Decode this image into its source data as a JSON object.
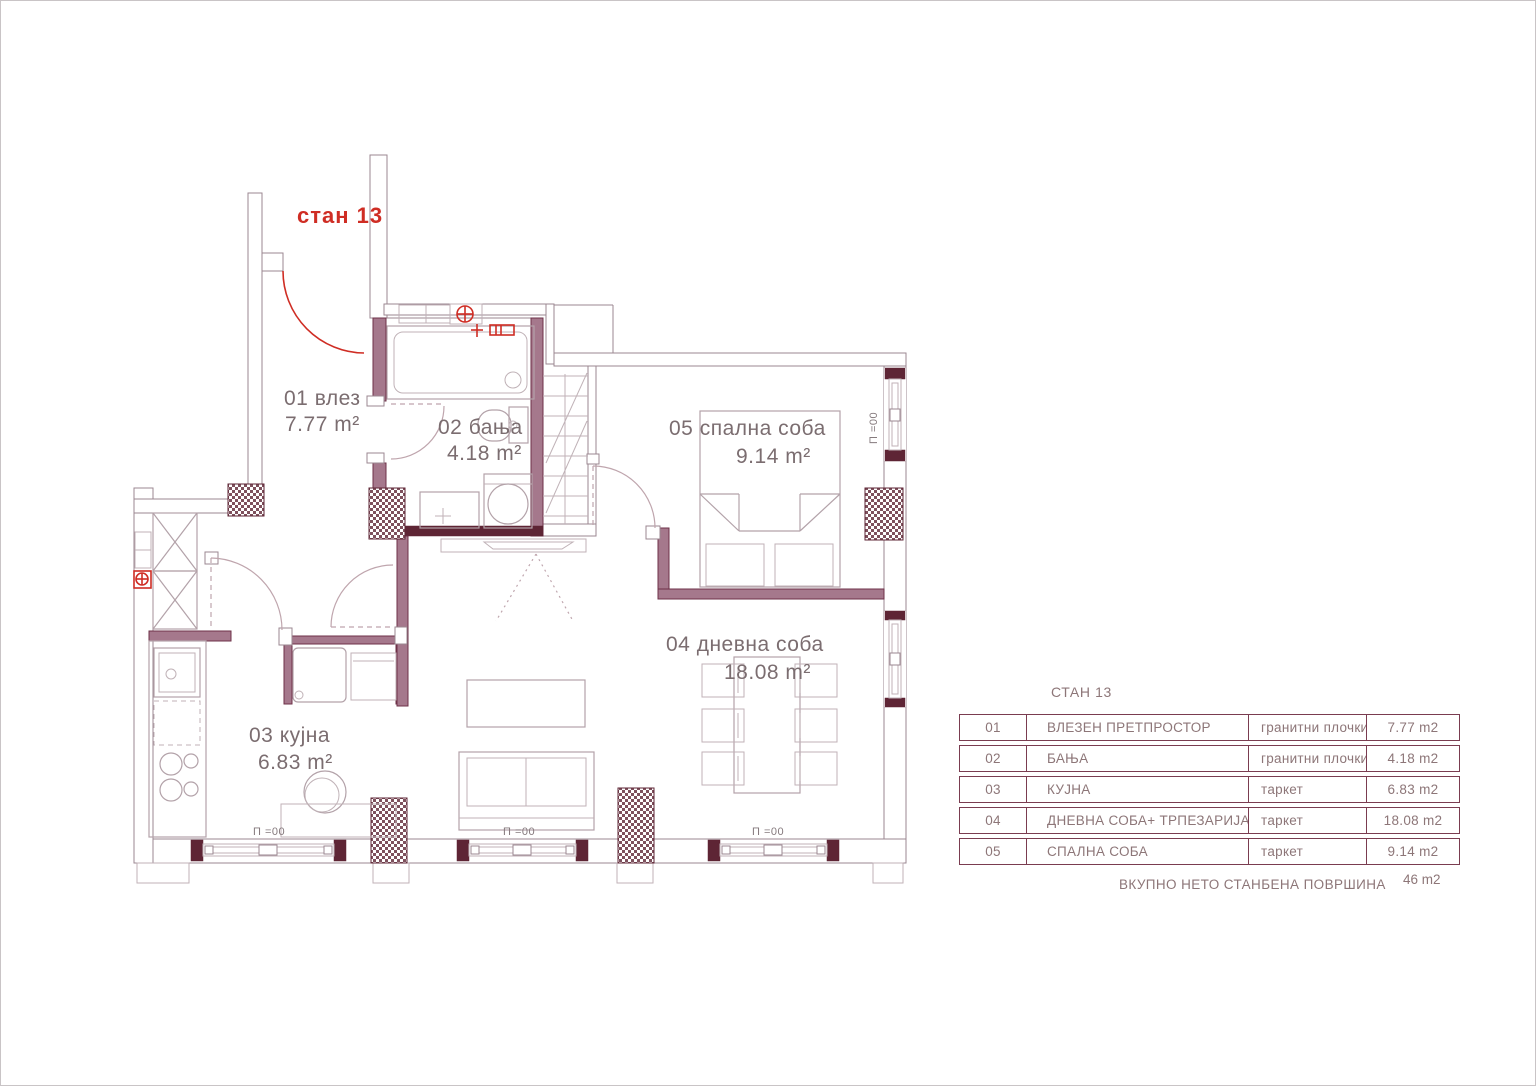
{
  "plan": {
    "unit_label": "стан 13",
    "rooms": [
      {
        "number": "01",
        "name": "01 влез",
        "area": "7.77 m²"
      },
      {
        "number": "02",
        "name": "02 бања",
        "area": "4.18 m²"
      },
      {
        "number": "03",
        "name": "03 кујна",
        "area": "6.83 m²"
      },
      {
        "number": "04",
        "name": "04 дневна соба",
        "area": "18.08 m²"
      },
      {
        "number": "05",
        "name": "05 спална соба",
        "area": "9.14 m²"
      }
    ],
    "window_parapet_label": "П =00"
  },
  "legend_table": {
    "title": "СТАН 13",
    "rows": [
      {
        "no": "01",
        "name": "ВЛЕЗЕН ПРЕТПРОСТОР",
        "floor": "гранитни плочки",
        "area": "7.77 m2"
      },
      {
        "no": "02",
        "name": "БАЊА",
        "floor": "гранитни плочки",
        "area": "4.18 m2"
      },
      {
        "no": "03",
        "name": "КУЈНА",
        "floor": "таркет",
        "area": "6.83 m2"
      },
      {
        "no": "04",
        "name": "ДНЕВНА СОБА+ ТРПЕЗАРИЈА",
        "floor": "таркет",
        "area": "18.08 m2"
      },
      {
        "no": "05",
        "name": "СПАЛНА СОБА",
        "floor": "таркет",
        "area": "9.14 m2"
      }
    ],
    "total_label": "ВКУПНО НЕТО СТАНБЕНА ПОВРШИНА",
    "total_value": "46 m2"
  },
  "colors": {
    "wall_dark": "#5e2535",
    "partition_fill": "#a5788c",
    "accent_red": "#cf2d24",
    "line_light": "#9b8791",
    "label_text": "#7b6d70",
    "table_border": "#7a3c50",
    "table_text": "#8d7678"
  }
}
